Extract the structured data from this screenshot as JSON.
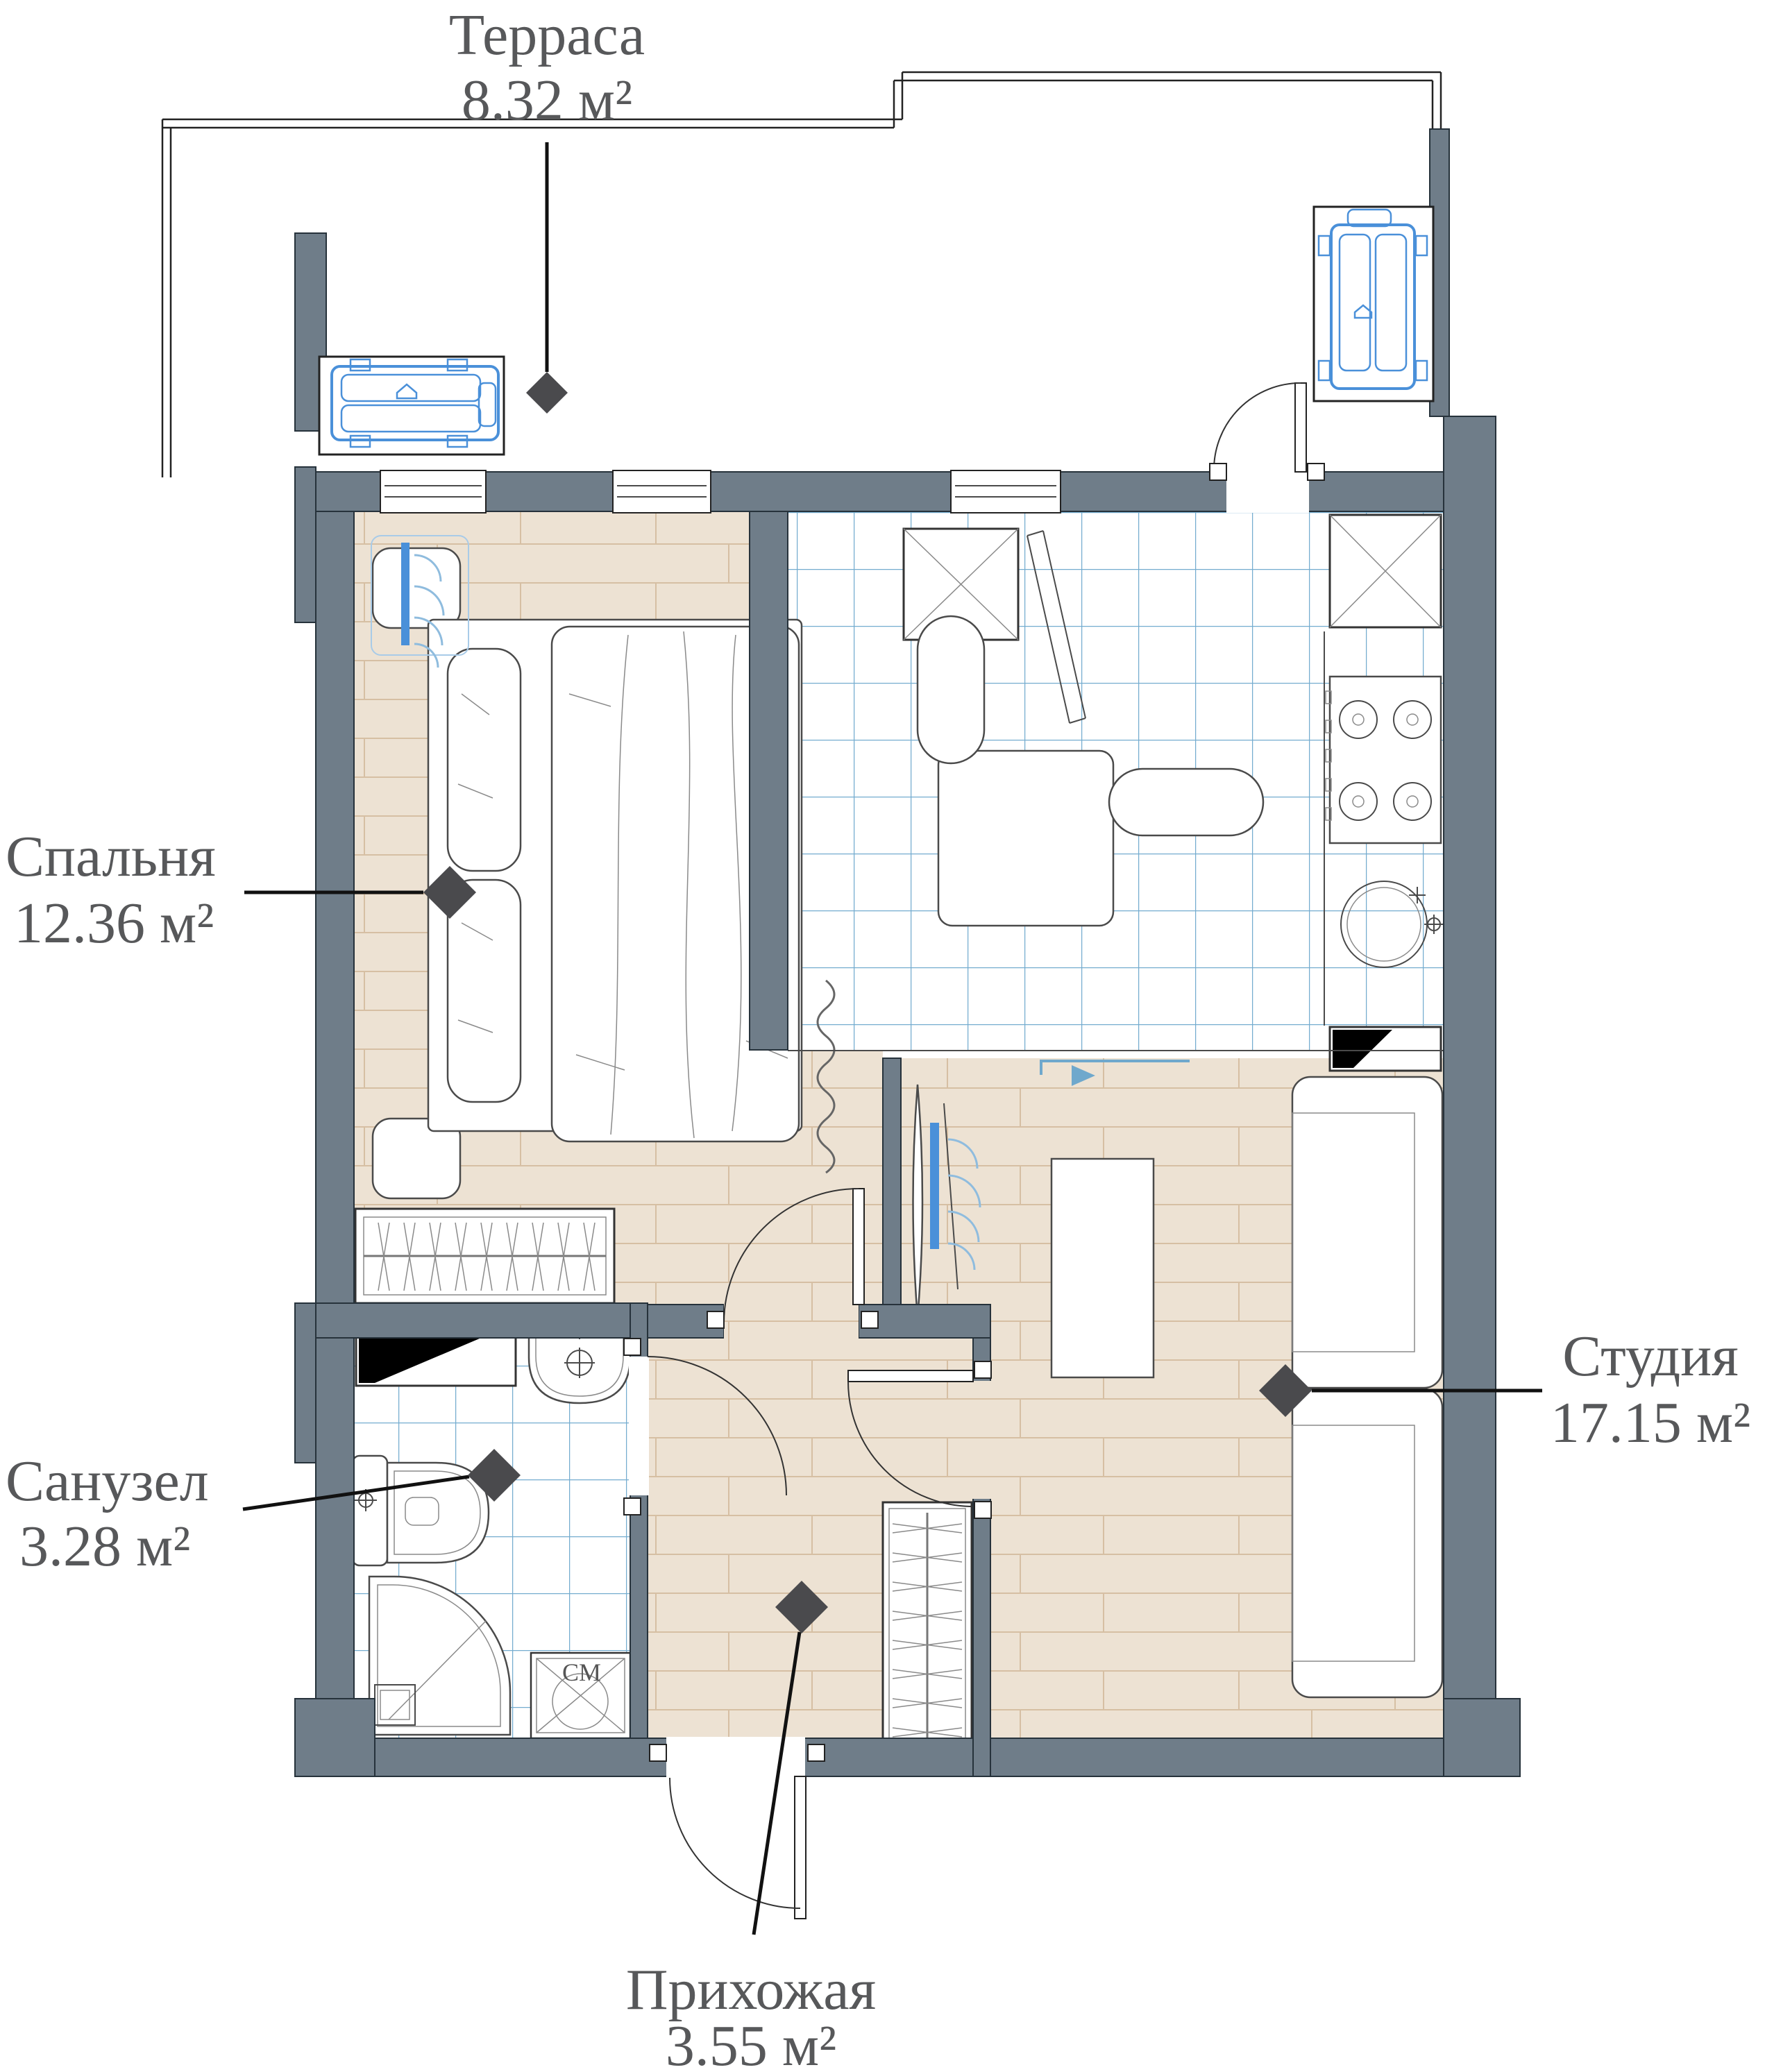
{
  "plan_title": "Floor plan of studio apartment",
  "rooms": [
    {
      "id": "terrace",
      "name": "Терраса",
      "area": "8.32 м²"
    },
    {
      "id": "bedroom",
      "name": "Спальня",
      "area": "12.36 м²"
    },
    {
      "id": "bathroom",
      "name": "Санузел",
      "area": "3.28 м²"
    },
    {
      "id": "hallway",
      "name": "Прихожая",
      "area": "3.55 м²"
    },
    {
      "id": "studio",
      "name": "Студия",
      "area": "17.15 м²"
    }
  ],
  "equipment": {
    "washer_label": "СМ"
  },
  "colors": {
    "wall": "#6F7D89",
    "wood_floor": "#EDE2D3",
    "wood_plank_line": "#D6BFA3",
    "tile_line": "#74ACCF",
    "equipment_blue": "#4A90D9",
    "label_text": "#57585A",
    "leader_marker": "#4a4a4d"
  }
}
